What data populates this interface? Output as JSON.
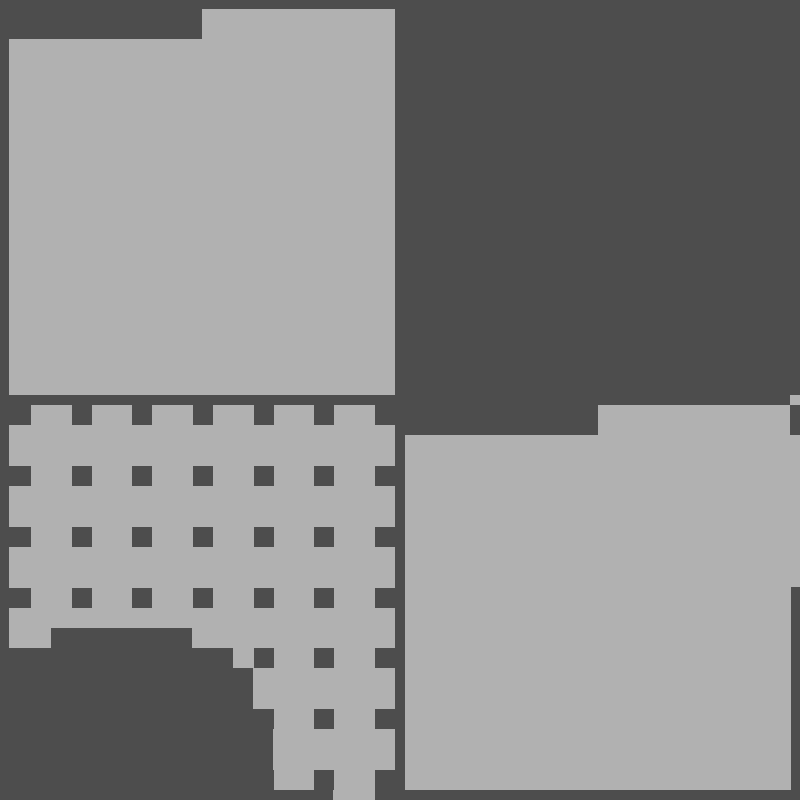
{
  "canvas": {
    "width": 800,
    "height": 800,
    "background_color": "#4d4d4d",
    "shape_color": "#b1b1b1"
  },
  "shapes": [
    {
      "name": "folder-block-top-left",
      "type": "polygon",
      "description": "large light block with raised tab on its top-right",
      "points": [
        [
          9,
          39
        ],
        [
          202,
          39
        ],
        [
          202,
          9
        ],
        [
          395,
          9
        ],
        [
          395,
          395
        ],
        [
          9,
          395
        ]
      ]
    },
    {
      "name": "waffle-panel",
      "type": "polygon",
      "description": "light block with grid of square holes, stair-stepped bottom edge",
      "points": [
        [
          9,
          405
        ],
        [
          395,
          405
        ],
        [
          395,
          770
        ],
        [
          375,
          770
        ],
        [
          375,
          800
        ],
        [
          333,
          800
        ],
        [
          333,
          790
        ],
        [
          273,
          790
        ],
        [
          273,
          709
        ],
        [
          253,
          709
        ],
        [
          253,
          668
        ],
        [
          233,
          668
        ],
        [
          233,
          648
        ],
        [
          192,
          648
        ],
        [
          192,
          628
        ],
        [
          51,
          628
        ],
        [
          51,
          648
        ],
        [
          9,
          648
        ]
      ]
    },
    {
      "name": "folder-block-bottom-right",
      "type": "polygon",
      "description": "large light block with raised tab on its top, right edge stepped",
      "points": [
        [
          405,
          435
        ],
        [
          598,
          435
        ],
        [
          598,
          405
        ],
        [
          790,
          405
        ],
        [
          790,
          435
        ],
        [
          800,
          435
        ],
        [
          800,
          587
        ],
        [
          791,
          587
        ],
        [
          791,
          790
        ],
        [
          405,
          790
        ]
      ]
    },
    {
      "name": "stray-pixel-top-right-of-folder",
      "type": "rect",
      "x": 790,
      "y": 395,
      "width": 10,
      "height": 10
    }
  ],
  "hole_grid": {
    "name": "waffle-holes",
    "description": "dark square holes punched into waffle-panel on a regular grid",
    "cols": [
      [
        9,
        22
      ],
      [
        72,
        20
      ],
      [
        132,
        20
      ],
      [
        193,
        20
      ],
      [
        254,
        20
      ],
      [
        314,
        20
      ],
      [
        375,
        20
      ]
    ],
    "rows": [
      [
        405,
        20
      ],
      [
        466,
        20
      ],
      [
        527,
        20
      ],
      [
        588,
        20
      ],
      [
        648,
        20
      ],
      [
        709,
        20
      ],
      [
        770,
        20
      ]
    ]
  }
}
